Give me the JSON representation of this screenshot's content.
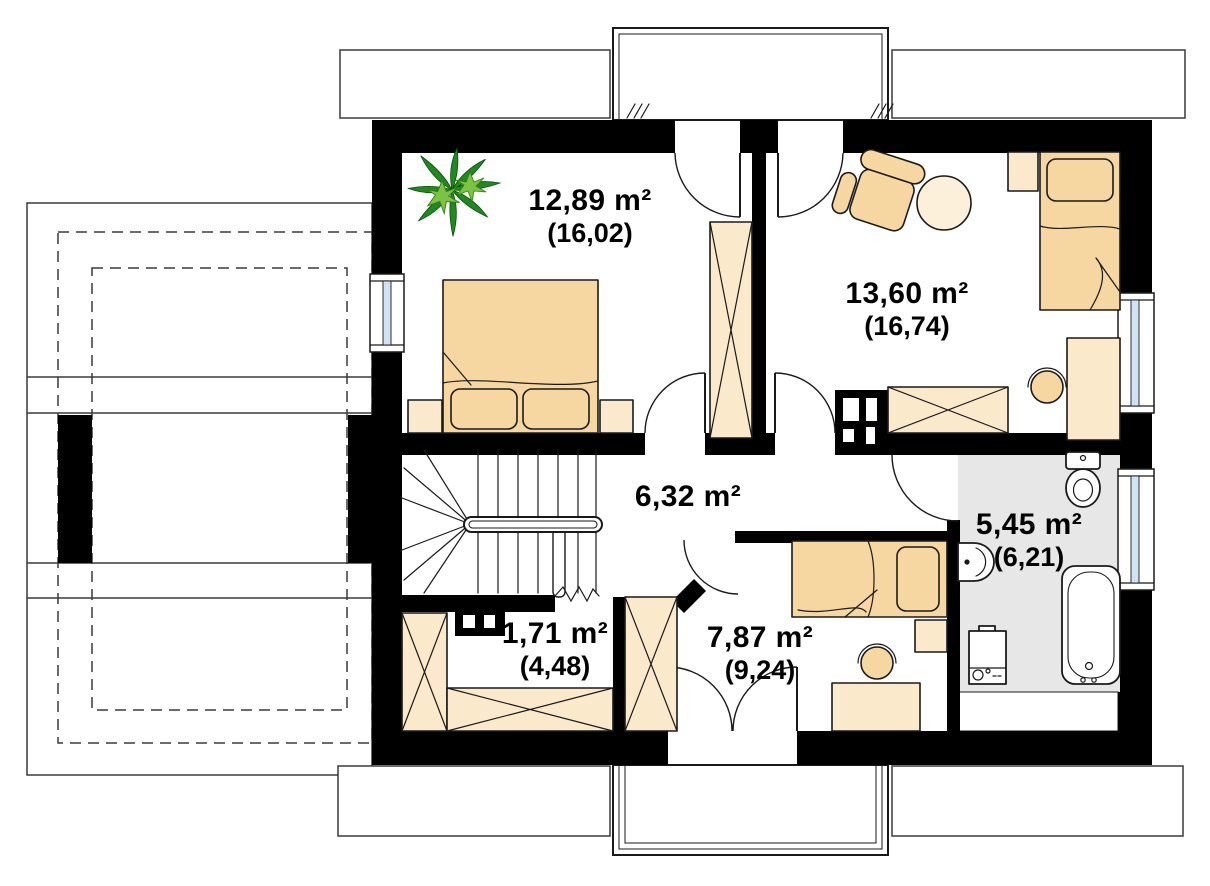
{
  "plan": {
    "title": "Attic floor plan",
    "rooms": [
      {
        "id": "bedroom-1",
        "area": "12,89 m²",
        "gross": "(16,02)"
      },
      {
        "id": "bedroom-2",
        "area": "13,60 m²",
        "gross": "(16,74)"
      },
      {
        "id": "hall",
        "area": "6,32 m²",
        "gross": ""
      },
      {
        "id": "bathroom",
        "area": "5,45 m²",
        "gross": "(6,21)"
      },
      {
        "id": "storage",
        "area": "1,71 m²",
        "gross": "(4,48)"
      },
      {
        "id": "bedroom-3",
        "area": "7,87 m²",
        "gross": "(9,24)"
      }
    ],
    "icons": [
      "double-bed",
      "single-bed",
      "wardrobe",
      "plant",
      "armchair",
      "round-table",
      "desk",
      "desk-chair",
      "nightstand",
      "toilet",
      "sink",
      "bathtub",
      "washing-machine",
      "stairs",
      "handrail",
      "chimney",
      "door-arc",
      "window",
      "balcony",
      "roof-eave"
    ],
    "colors": {
      "wall": "#000000",
      "furniture": "#f6d7a2",
      "furniture_light": "#fbe9cc",
      "furniture_pale": "#fdf0da",
      "bath_floor": "#e7e7e7",
      "window_glass": "#cfe3f5",
      "plant_dark": "#1f8a1f",
      "plant_light": "#7dc242",
      "line": "#1a1a1a"
    }
  }
}
